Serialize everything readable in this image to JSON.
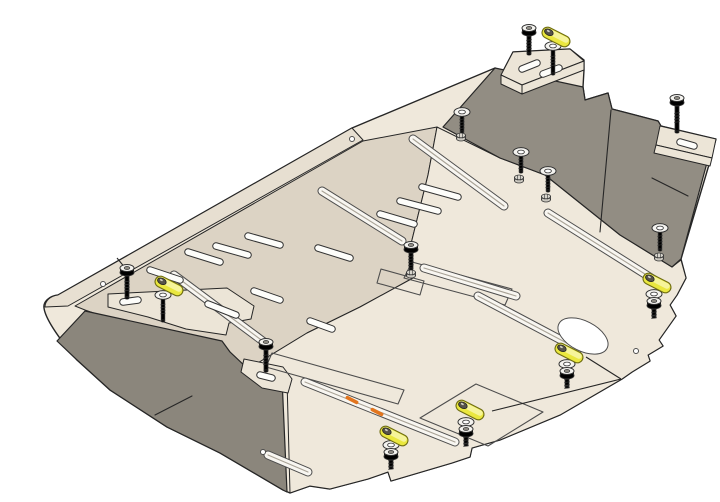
{
  "diagram": {
    "kind": "exploded-installation-diagram",
    "subject": "engine-skid-plate-with-mounting-hardware",
    "background": "#ffffff"
  },
  "palette": {
    "bg": "#ffffff",
    "ink": "#262626",
    "line-soft": "#4d4d4d",
    "plate-light": "#efe8db",
    "plate-tan": "#dcd3c4",
    "plate-band": "#e7dfd1",
    "bracket": "#ece5d7",
    "flange-dark": "#928d83",
    "flange-dark2": "#8b867c",
    "rib-fill": "#f8f6f1",
    "rib-core": "#a8a296",
    "slot-fill": "#fdfdfa",
    "hw-fill": "#ececе8",
    "hw-light": "#f4f3ef",
    "hw-stroke": "#333333",
    "nut-fill": "#c9c6be",
    "spacer-yellow": "#eae73f",
    "spacer-hi": "#f6f49a",
    "spacer-stroke": "#6f6d12",
    "screw-head": "#56534a",
    "orange": "#e2751e"
  },
  "plate": {
    "ribs": [
      [
        413,
        139,
        504,
        206
      ],
      [
        322,
        191,
        402,
        241
      ],
      [
        174,
        275,
        268,
        345
      ],
      [
        548,
        213,
        656,
        281
      ],
      [
        424,
        268,
        516,
        296
      ],
      [
        305,
        382,
        455,
        442
      ],
      [
        478,
        296,
        578,
        349
      ],
      [
        268,
        455,
        308,
        472
      ]
    ],
    "rib_width": 7,
    "vent_slots": [
      [
        422,
        187,
        458,
        197
      ],
      [
        400,
        201,
        438,
        211
      ],
      [
        380,
        214,
        414,
        224
      ],
      [
        318,
        248,
        350,
        258
      ],
      [
        248,
        236,
        280,
        245
      ],
      [
        216,
        246,
        248,
        255
      ],
      [
        188,
        252,
        220,
        262
      ],
      [
        150,
        270,
        180,
        280
      ],
      [
        254,
        291,
        280,
        300
      ],
      [
        208,
        304,
        236,
        315
      ],
      [
        310,
        321,
        332,
        329
      ]
    ],
    "bracket_slots": [
      [
        522,
        69,
        537,
        63
      ],
      [
        543,
        74,
        559,
        68
      ],
      [
        680,
        142,
        694,
        146
      ],
      [
        123,
        302,
        138,
        300
      ],
      [
        260,
        375,
        272,
        378
      ]
    ],
    "slot_width": 5.5,
    "pads": [
      "M412,262 L512,289 L505,305 L404,278 Z",
      "M476,384 L543,412 L488,446 L420,418 Z",
      "M272,353 L404,390 L398,404 L266,367 Z",
      "M381,269 L424,281 L420,295 L377,283 Z"
    ],
    "oval_hole": {
      "cx": 583,
      "cy": 336,
      "rx": 27,
      "ry": 15,
      "angle": 27
    },
    "round_holes": [
      [
        103,
        284
      ],
      [
        352,
        139
      ],
      [
        636,
        351
      ],
      [
        263,
        452
      ]
    ],
    "creases": [
      [
        652,
        178,
        688,
        196
      ],
      [
        611,
        110,
        600,
        232
      ],
      [
        155,
        415,
        192,
        396
      ]
    ]
  },
  "hardware": {
    "flange_bolts": [
      {
        "x": 529,
        "y": 30,
        "len": 22
      },
      {
        "x": 677,
        "y": 100,
        "len": 30
      },
      {
        "x": 127,
        "y": 270,
        "len": 26
      },
      {
        "x": 266,
        "y": 344,
        "len": 25
      },
      {
        "x": 411,
        "y": 247,
        "len": 20
      }
    ],
    "washer_studs": [
      {
        "x": 462,
        "y": 112,
        "len": 20
      },
      {
        "x": 521,
        "y": 152,
        "len": 20
      },
      {
        "x": 548,
        "y": 171,
        "len": 20
      },
      {
        "x": 660,
        "y": 228,
        "len": 22
      },
      {
        "x": 553,
        "y": 46,
        "len": 28
      },
      {
        "x": 163,
        "y": 295,
        "len": 26
      }
    ],
    "nuts": [
      [
        461,
        137
      ],
      [
        519,
        179
      ],
      [
        546,
        198
      ],
      [
        659,
        257
      ],
      [
        411,
        274
      ]
    ],
    "spacers": [
      [
        556,
        37
      ],
      [
        169,
        286
      ],
      [
        394,
        436
      ],
      [
        470,
        410
      ],
      [
        569,
        353
      ],
      [
        657,
        283
      ]
    ],
    "spacer_angle": 27,
    "down_stacks": [
      [
        391,
        445
      ],
      [
        466,
        422
      ],
      [
        567,
        364
      ],
      [
        654,
        294
      ]
    ]
  },
  "annotations": {
    "leader_lines": [
      [
        492,
        411,
        621,
        379
      ],
      [
        586,
        357,
        621,
        379
      ],
      [
        117,
        258,
        126,
        269
      ]
    ],
    "rib_marks": [
      [
        352,
        400
      ],
      [
        377,
        412
      ]
    ],
    "rib_mark_angle": 27
  }
}
